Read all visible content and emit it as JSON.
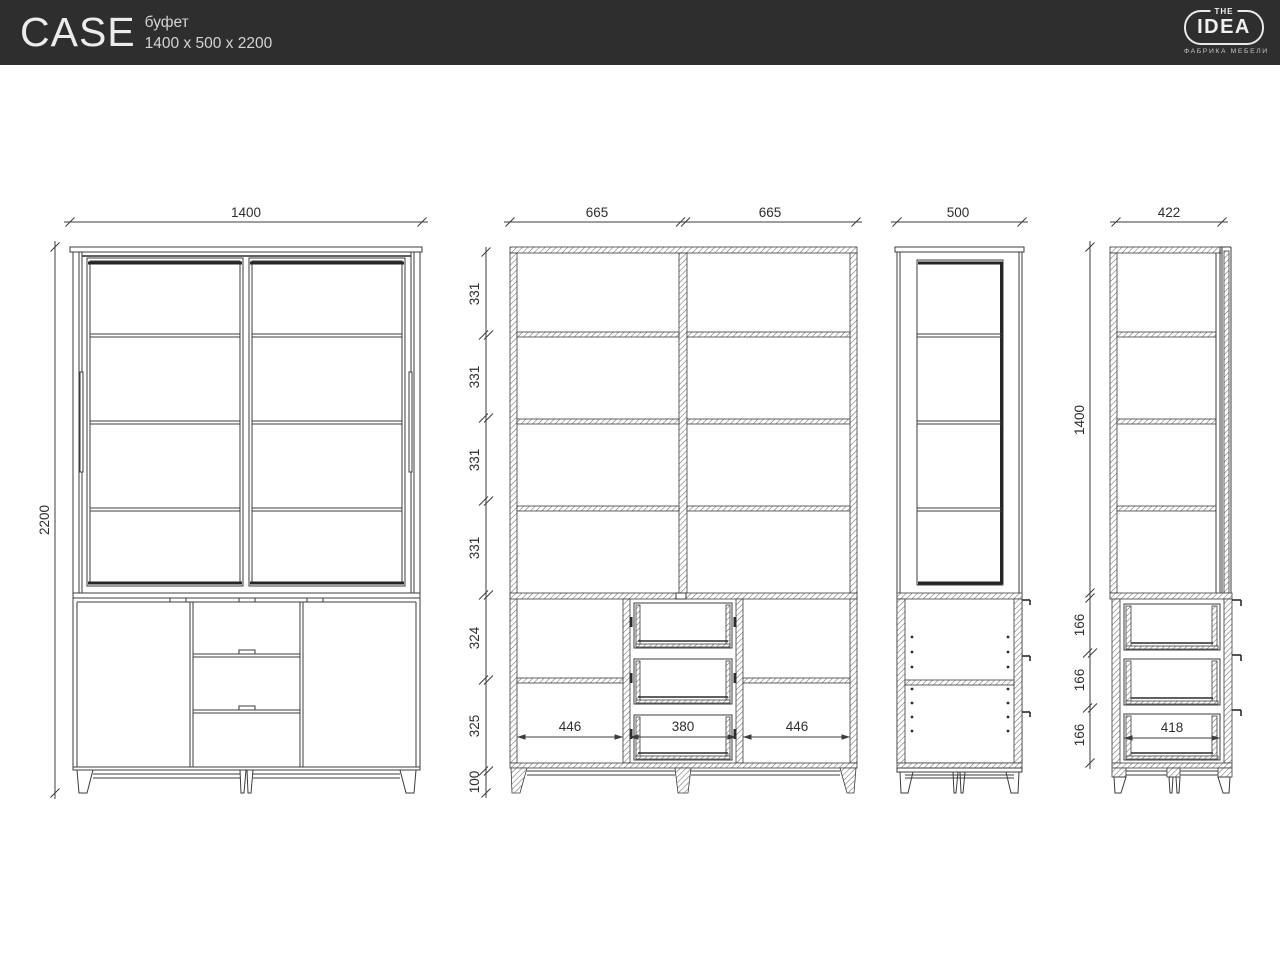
{
  "header": {
    "product_name": "CASE",
    "product_type": "буфет",
    "product_dimensions": "1400 x 500 x 2200"
  },
  "logo": {
    "the": "THE",
    "idea": "IDEA",
    "tagline": "ФАБРИКА МЕБЕЛИ"
  },
  "drawing": {
    "front_view": {
      "width": "1400",
      "height": "2200"
    },
    "front_section": {
      "width_left": "665",
      "width_right": "665",
      "heights": [
        "331",
        "331",
        "331",
        "331",
        "324",
        "325",
        "100"
      ],
      "inner_widths": [
        "446",
        "380",
        "446"
      ]
    },
    "side_view": {
      "width": "500"
    },
    "side_section": {
      "width": "422",
      "upper_height": "1400",
      "drawer_heights": [
        "166",
        "166",
        "166"
      ],
      "drawer_width": "418"
    }
  },
  "colors": {
    "header_bg": "#2e2e2e",
    "header_text": "#ececec",
    "line": "#3c3c3c",
    "canvas": "#ffffff"
  }
}
